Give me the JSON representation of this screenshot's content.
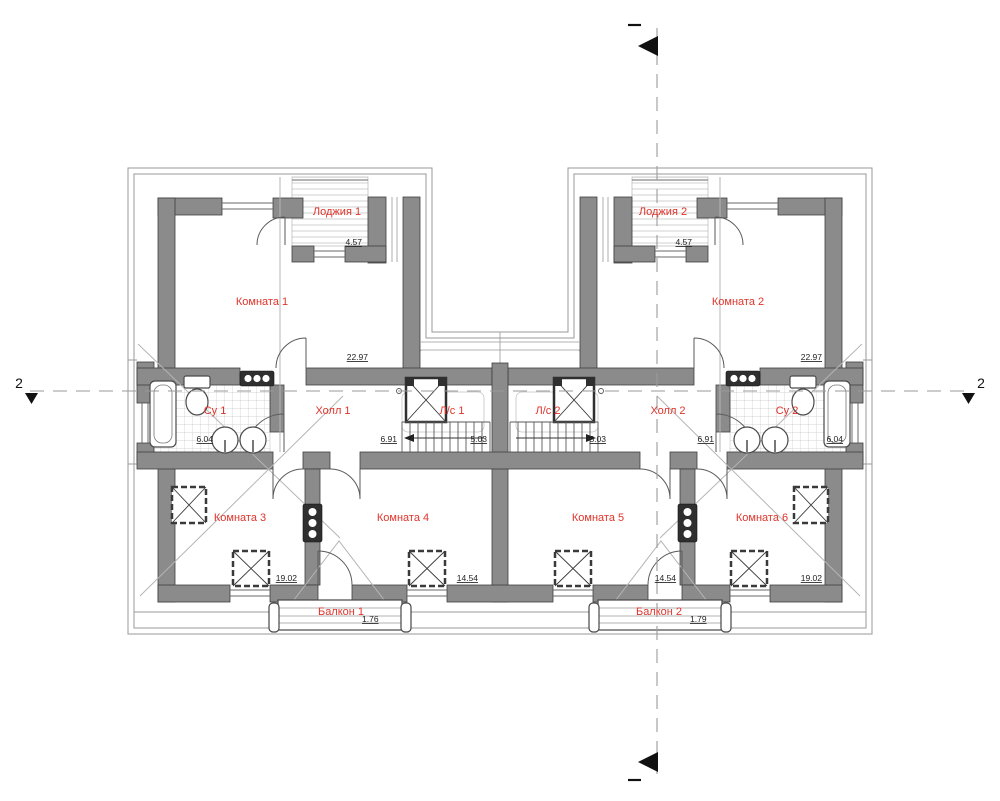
{
  "rooms": {
    "loggia1": {
      "label": "Лоджия 1",
      "area": "4.57"
    },
    "room1": {
      "label": "Комната 1",
      "area": "22.97"
    },
    "su1": {
      "label": "Су 1",
      "area": "6.04"
    },
    "hall1": {
      "label": "Холл 1",
      "area": "6.91"
    },
    "stair1": {
      "label": "Л/с 1",
      "area": "5.03"
    },
    "room3": {
      "label": "Комната 3",
      "area": "19.02"
    },
    "room4": {
      "label": "Комната 4",
      "area": "14.54"
    },
    "balcony1": {
      "label": "Балкон 1",
      "area": "1.76"
    },
    "loggia2": {
      "label": "Лоджия 2",
      "area": "4.57"
    },
    "room2": {
      "label": "Комната 2",
      "area": "22.97"
    },
    "su2": {
      "label": "Су 2",
      "area": "6.04"
    },
    "hall2": {
      "label": "Холл 2",
      "area": "6.91"
    },
    "stair2": {
      "label": "Л/с 2",
      "area": "5.03"
    },
    "room5": {
      "label": "Комната 5",
      "area": "14.54"
    },
    "room6": {
      "label": "Комната 6",
      "area": "19.02"
    },
    "balcony2": {
      "label": "Балкон 2",
      "area": "1.79"
    }
  },
  "markers": {
    "section_left": "2",
    "section_right": "2"
  },
  "colors": {
    "room_label": "#e0342b",
    "wall_fill": "#8b8b8b",
    "section_line": "#9a9a9a"
  }
}
